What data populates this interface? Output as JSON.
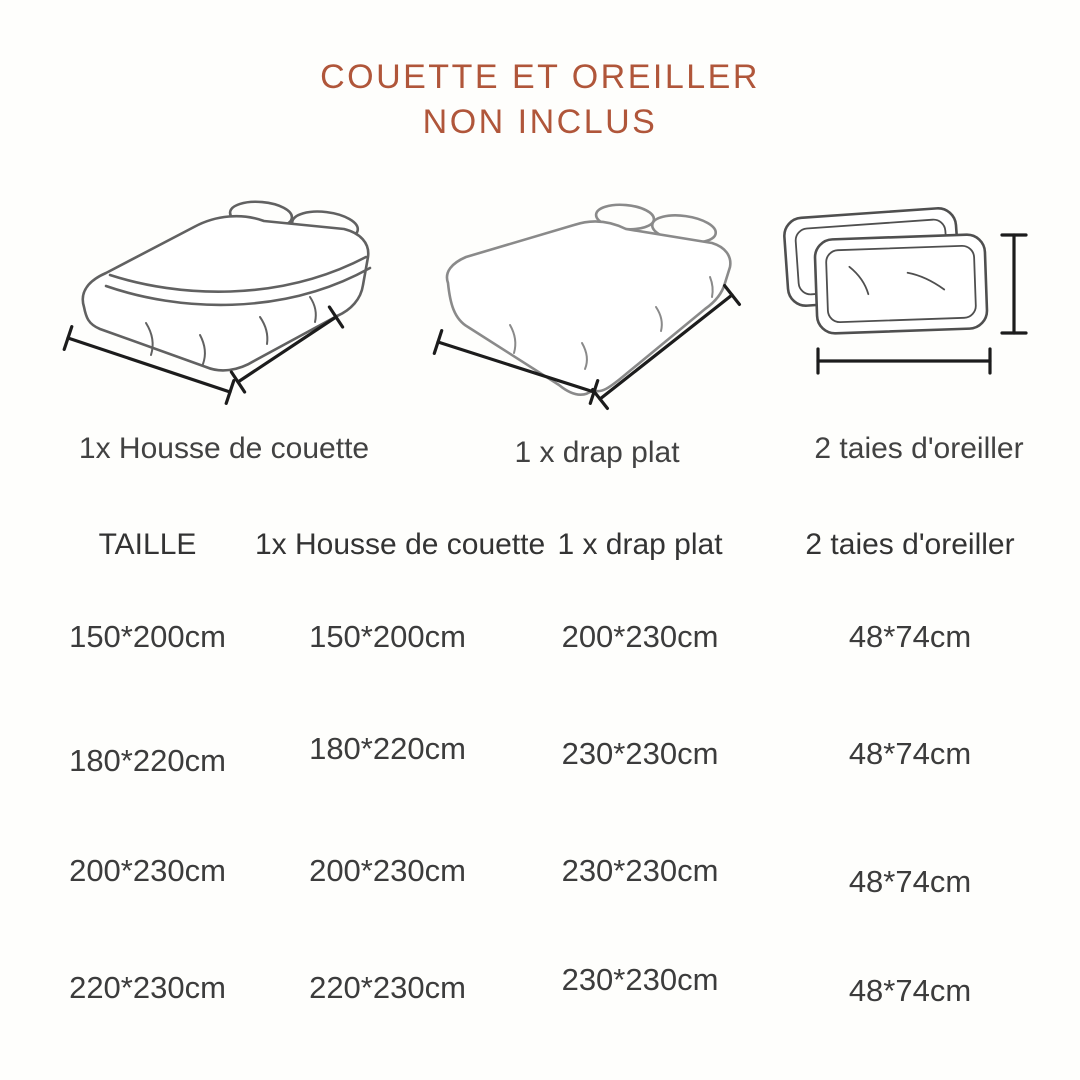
{
  "title": {
    "line1": "COUETTE ET OREILLER",
    "line2": "NON INCLUS"
  },
  "figures": [
    {
      "icon": "duvet-cover-bed-illustration",
      "label": "1x Housse de couette"
    },
    {
      "icon": "flat-sheet-bed-illustration",
      "label": "1 x drap plat"
    },
    {
      "icon": "pillowcases-illustration",
      "label": "2 taies d'oreiller"
    }
  ],
  "size_table": {
    "headers": [
      "TAILLE",
      "1x Housse de couette",
      "1 x drap plat",
      "2 taies d'oreiller"
    ],
    "rows": [
      [
        "150*200cm",
        "150*200cm",
        "200*230cm",
        "48*74cm"
      ],
      [
        "180*220cm",
        "180*220cm",
        "230*230cm",
        "48*74cm"
      ],
      [
        "200*230cm",
        "200*230cm",
        "230*230cm",
        "48*74cm"
      ],
      [
        "220*230cm",
        "220*230cm",
        "230*230cm",
        "48*74cm"
      ]
    ]
  },
  "colors": {
    "title_accent": "#b0563a",
    "text": "#3c3c3c",
    "sketch_line": "#616161",
    "sheet_sketch_line": "#8a8a8a",
    "dimension_line": "#1c1c1c",
    "background": "#fefefc"
  }
}
